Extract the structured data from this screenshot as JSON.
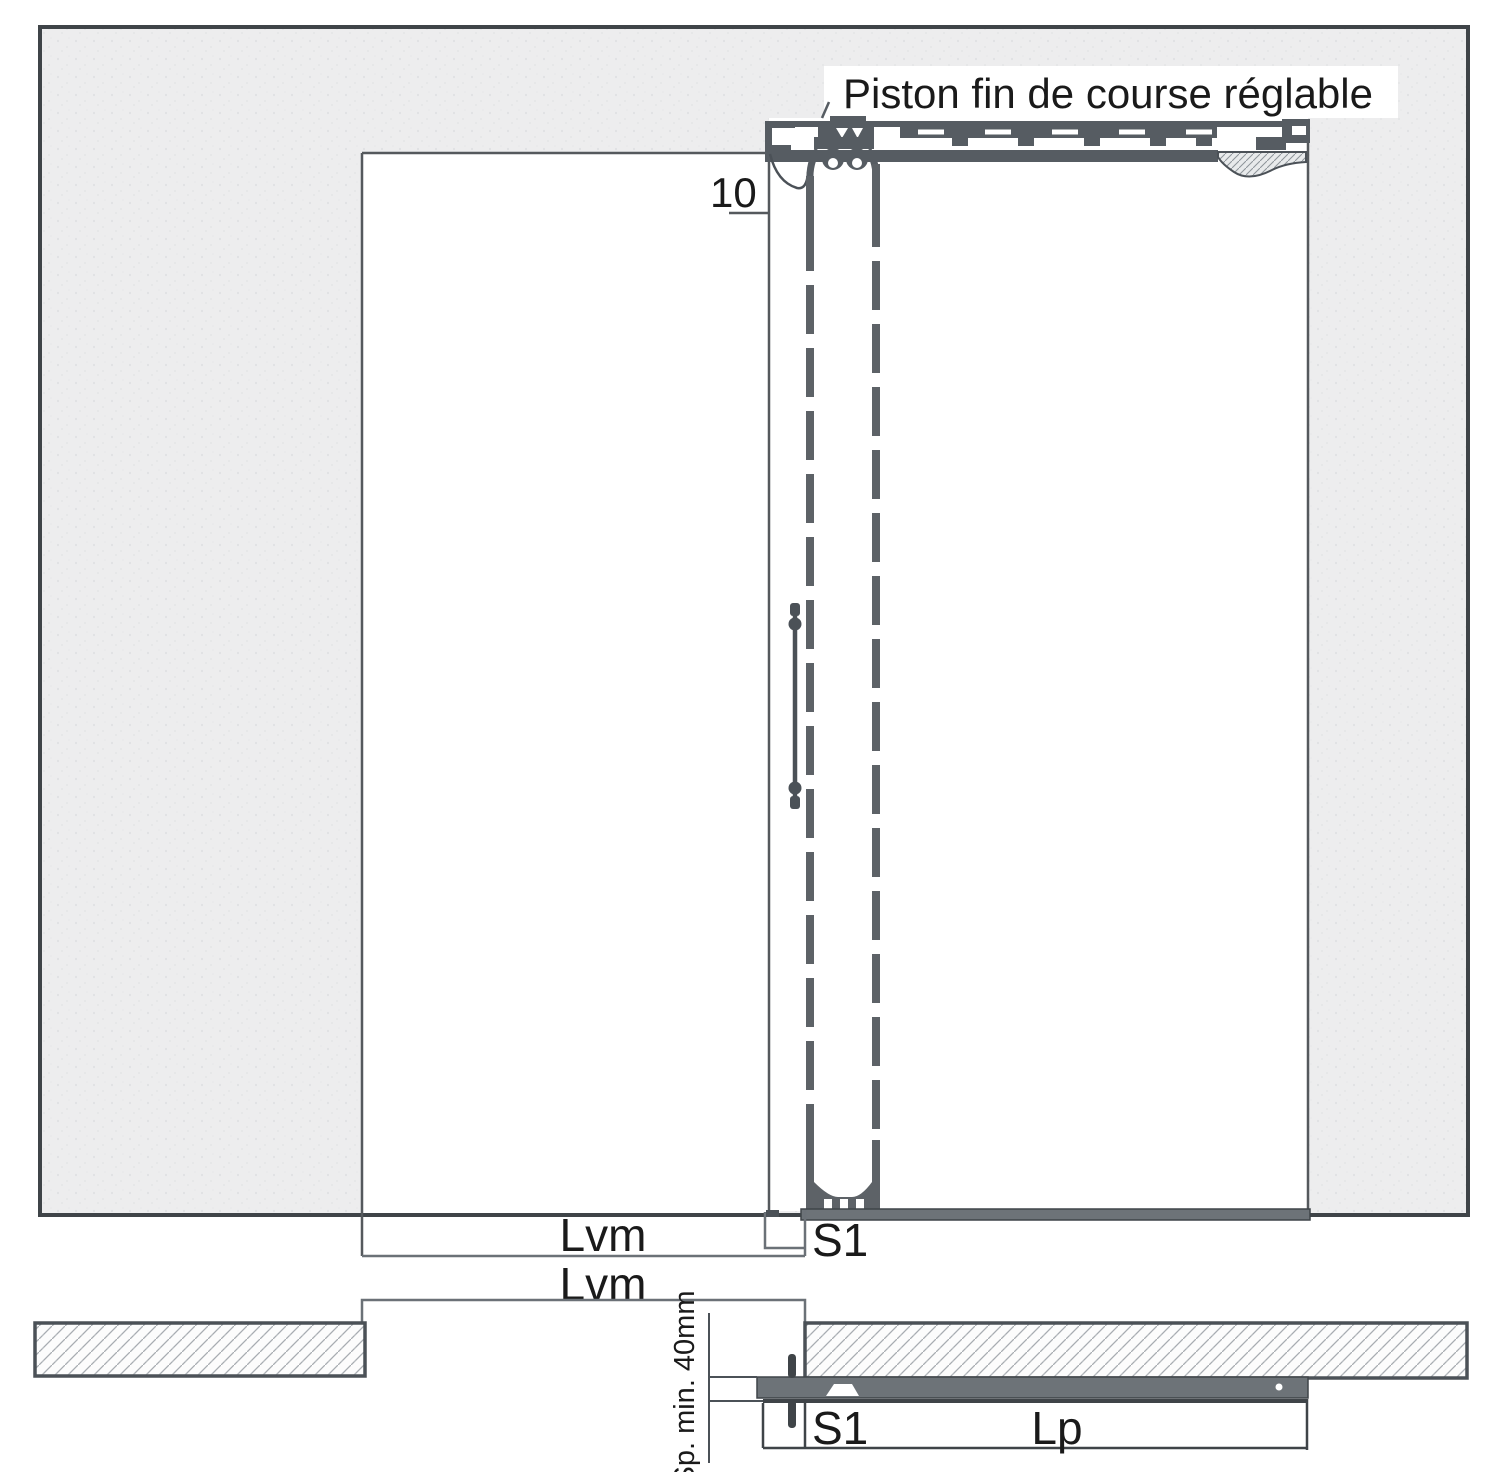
{
  "diagram": {
    "type": "technical-drawing",
    "title": "Piston fin de course réglable",
    "labels": {
      "gap_top": "10",
      "lvm_elevation": "Lvm",
      "lvm_plan": "Lvm",
      "s1_elevation": "S1",
      "s1_plan": "S1",
      "lp": "Lp",
      "sp_min": "Sp. min. 40mm"
    },
    "colors": {
      "line_dark": "#3f4448",
      "machinery": "#565c62",
      "band_fill": "#6d7378",
      "wall_fill": "#ededee",
      "hatch_line": "#a7acb1",
      "text": "#1a1a1a"
    }
  }
}
